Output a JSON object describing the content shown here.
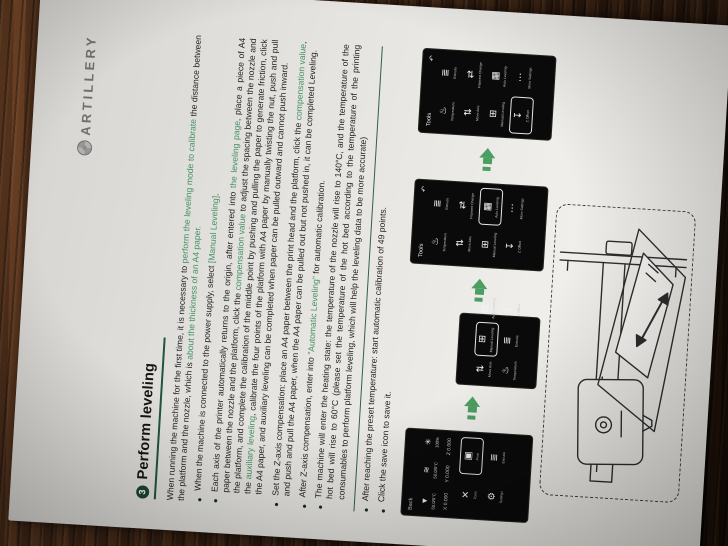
{
  "colors": {
    "accent_green": "#20543c",
    "highlight_text_green": "#459063",
    "arrow_green": "#4c9e63",
    "badge_green": "#1c4434",
    "screen_bg": "#0a0a0a",
    "page_bg": "#ecebe7"
  },
  "logo": {
    "text": "ARTILLERY",
    "mark": "artillery-gear-logo"
  },
  "section": {
    "number": "3",
    "title": "Perform leveling"
  },
  "intro": {
    "segments": [
      {
        "t": "When running the machine for the first time, it is necessary to "
      },
      {
        "t": "perform the leveling mode to calibrate",
        "g": true
      },
      {
        "t": " the distance between the platform and the nozzle, which is "
      },
      {
        "t": "about the thickness of an A4 paper.",
        "g": true
      }
    ]
  },
  "bullets_before_rule": [
    {
      "segments": [
        {
          "t": "When the machine is connected to the power supply, select "
        },
        {
          "t": "[Manual Leveling]",
          "g": true
        },
        {
          "t": "."
        }
      ]
    },
    {
      "segments": [
        {
          "t": "Each axis of the printer automatically returns to the origin, after entered into "
        },
        {
          "t": "the leveling page",
          "g": true
        },
        {
          "t": ", place a piece of A4 paper between the nozzle and the platform, click the "
        },
        {
          "t": "compensation value",
          "g": true
        },
        {
          "t": " to adjust the spacing between the nozzle and the platform, and complete the calibration of the middle point by pushing and pulling the paper to generate friction, click the "
        },
        {
          "t": "auxiliary leveling",
          "g": true
        },
        {
          "t": ", calibrate the four points of the platform with A4 paper by manually twisting the nut, push and pull the A4 paper, and auxiliary leveling can be completed when paper can be pulled outward and cannot push inward."
        }
      ]
    },
    {
      "segments": [
        {
          "t": "Set the Z-axis compensation: place an A4 paper between the print head and the platform, click the "
        },
        {
          "t": "compensation value",
          "g": true
        },
        {
          "t": ", and push and pull the A4 paper, when the A4 paper can be pulled out but not pushed in, it can be completed Leveling."
        }
      ]
    },
    {
      "segments": [
        {
          "t": "After Z-axis compensation, enter into "
        },
        {
          "t": "\"Automatic Leveling\"",
          "g": true
        },
        {
          "t": " for automatic calibration."
        }
      ]
    },
    {
      "segments": [
        {
          "t": "The machine will enter the heating state: the temperature of the nozzle will rise to 140°C, and the temperature of the hot bed will rise to 60°C (please set the temperature of the hot bed according to the temperature of the printing consumables to perform platform leveling, which will help the leveling data to be more accurate)"
        }
      ]
    }
  ],
  "bullets_after_rule": [
    {
      "segments": [
        {
          "t": "After reaching the preset temperature: start automatic calibration of 49 points."
        }
      ]
    },
    {
      "segments": [
        {
          "t": "Click the save icon to save it."
        }
      ]
    }
  ],
  "screens": [
    {
      "id": "home-screen",
      "kind": "home",
      "back_label": "Back",
      "status": [
        {
          "icon": "nozzle-icon",
          "glyph": "▼",
          "value": "50.0/0°C"
        },
        {
          "icon": "hotbed-icon",
          "glyph": "≋",
          "value": "50.0/0°C"
        },
        {
          "icon": "fan-icon",
          "glyph": "✳",
          "value": "100%"
        }
      ],
      "coords": [
        "X 0.000",
        "Y 0.000",
        "Z 0.000"
      ],
      "nav": [
        {
          "icon": "tools-icon",
          "glyph": "✕",
          "label": "Tools",
          "highlighted": false
        },
        {
          "icon": "print-icon",
          "glyph": "▣",
          "label": "Print",
          "highlighted": true
        },
        {
          "icon": "settings-icon",
          "glyph": "⚙",
          "label": "Settings",
          "highlighted": false
        },
        {
          "icon": "extrude-icon",
          "glyph": "≣",
          "label": "Extrude",
          "highlighted": false
        }
      ]
    },
    {
      "id": "leveling-menu-screen",
      "kind": "pop",
      "items": [
        {
          "icon": "move-axis-icon",
          "glyph": "⇅",
          "label": "Move Axis",
          "highlighted": false
        },
        {
          "icon": "manual-leveling-icon",
          "glyph": "⊞",
          "label": "Manual Leveling",
          "highlighted": true
        },
        {
          "icon": "auto-leveling-icon",
          "glyph": "▦",
          "label": "Auto Leveling",
          "highlighted": false
        },
        {
          "icon": "temperature-icon",
          "glyph": "♨",
          "label": "Temperature",
          "highlighted": false
        },
        {
          "icon": "extrude-icon",
          "glyph": "≣",
          "label": "Extrude",
          "highlighted": false
        },
        {
          "icon": "z-offset-icon",
          "glyph": "↧",
          "label": "Z Offset",
          "highlighted": false
        }
      ]
    },
    {
      "id": "tools-auto-leveling-screen",
      "kind": "tools",
      "title": "Tools",
      "back_glyph": "↶",
      "items": [
        {
          "icon": "temperature-icon",
          "glyph": "♨",
          "label": "Temperature",
          "highlighted": false
        },
        {
          "icon": "extrude-icon",
          "glyph": "≣",
          "label": "Extrude",
          "highlighted": false
        },
        {
          "icon": "move-axis-icon",
          "glyph": "⇅",
          "label": "Move Axis",
          "highlighted": false
        },
        {
          "icon": "filament-change-icon",
          "glyph": "⇄",
          "label": "Filament Change",
          "highlighted": false
        },
        {
          "icon": "manual-leveling-icon",
          "glyph": "⊞",
          "label": "Manual Leveling",
          "highlighted": false
        },
        {
          "icon": "auto-leveling-icon",
          "glyph": "▦",
          "label": "Auto Leveling",
          "highlighted": true
        },
        {
          "icon": "z-offset-icon",
          "glyph": "↧",
          "label": "Z Offset",
          "highlighted": false
        },
        {
          "icon": "more-settings-icon",
          "glyph": "⋯",
          "label": "More Settings",
          "highlighted": false
        }
      ]
    },
    {
      "id": "tools-save-screen",
      "kind": "tools",
      "title": "Tools",
      "back_glyph": "↶",
      "items": [
        {
          "icon": "temperature-icon",
          "glyph": "♨",
          "label": "Temperature",
          "highlighted": false
        },
        {
          "icon": "extrude-icon",
          "glyph": "≣",
          "label": "Extrude",
          "highlighted": false
        },
        {
          "icon": "move-axis-icon",
          "glyph": "⇅",
          "label": "Move Axis",
          "highlighted": false
        },
        {
          "icon": "filament-change-icon",
          "glyph": "⇄",
          "label": "Filament Change",
          "highlighted": false
        },
        {
          "icon": "manual-leveling-icon",
          "glyph": "⊞",
          "label": "Manual Leveling",
          "highlighted": false
        },
        {
          "icon": "auto-leveling-icon",
          "glyph": "▦",
          "label": "Auto Leveling",
          "highlighted": false
        },
        {
          "icon": "z-offset-icon",
          "glyph": "↧",
          "label": "Z Offset",
          "highlighted": true
        },
        {
          "icon": "more-settings-icon",
          "glyph": "⋯",
          "label": "More Settings",
          "highlighted": false
        }
      ]
    }
  ],
  "illustration": {
    "type": "printer-line-drawing",
    "shows": "print head over bed with A4 paper pull direction arrow"
  }
}
